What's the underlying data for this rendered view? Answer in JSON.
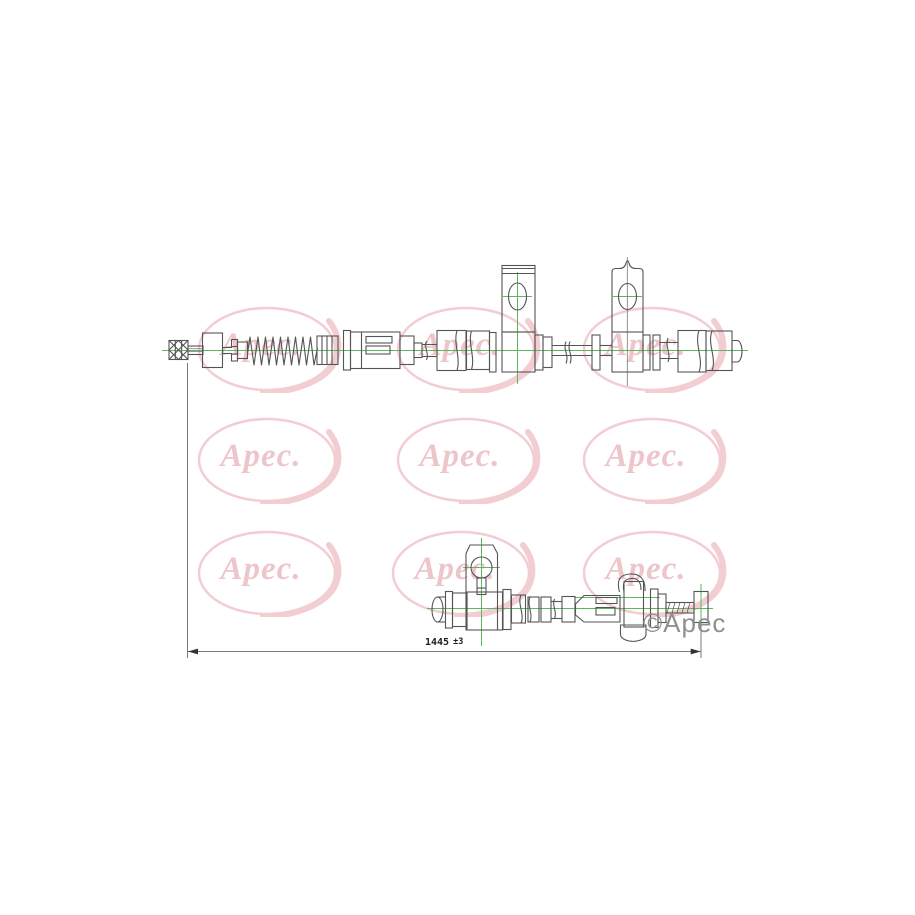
{
  "page": {
    "background": "#ffffff"
  },
  "watermark": {
    "text": "Apec.",
    "color": "#f2cdd1"
  },
  "copyright": {
    "text": "©Apec",
    "color": "#8f8f8f"
  },
  "dimension": {
    "value": "1445",
    "tolerance": "±3",
    "label": "1445 ±3"
  },
  "drawing": {
    "line_color": "#555555",
    "centerline_color": "#5eb75e"
  }
}
